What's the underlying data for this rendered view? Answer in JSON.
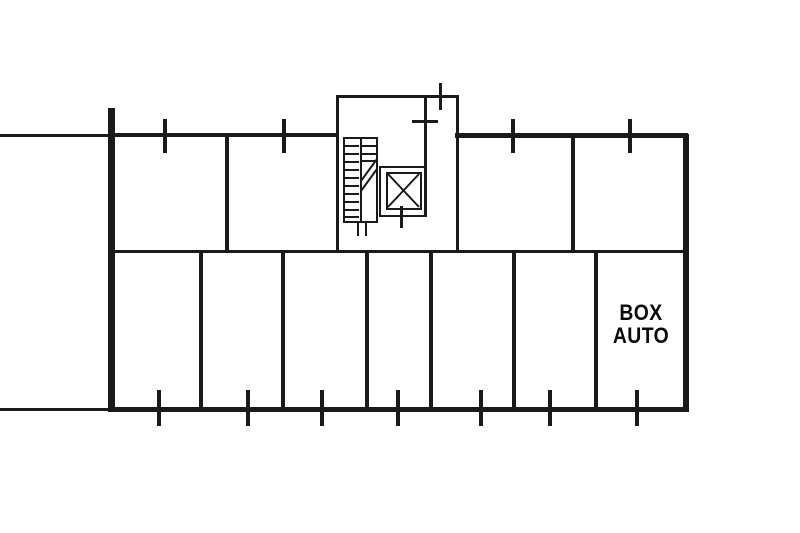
{
  "label": {
    "line1": "BOX",
    "line2": "AUTO"
  },
  "colors": {
    "background": "#ffffff",
    "line": "#1a1a1a",
    "text": "#0a0a0a"
  },
  "plan": {
    "ticks": {
      "top_wall_x": [
        165,
        284,
        513,
        630
      ],
      "bottom_wall_x": [
        159,
        248,
        322,
        398,
        481,
        550,
        637
      ],
      "protrusion_x": [
        440
      ],
      "elevator_x": [
        401
      ]
    },
    "dividers": {
      "upper_x": [
        227,
        573
      ],
      "lower_x": [
        201,
        283,
        367,
        431,
        514,
        596
      ]
    },
    "stairs": {
      "treads_left_y": [
        145,
        153,
        161,
        169,
        177,
        185,
        193,
        201,
        209,
        216
      ],
      "treads_right_y": [
        145,
        153,
        160
      ]
    },
    "rooms": [
      {
        "name": "upper-room-1",
        "x": 112,
        "y": 137,
        "w": 115,
        "h": 113
      },
      {
        "name": "upper-room-2",
        "x": 227,
        "y": 137,
        "w": 110,
        "h": 113
      },
      {
        "name": "stairwell",
        "x": 337,
        "y": 97,
        "w": 122,
        "h": 153
      },
      {
        "name": "upper-room-3",
        "x": 459,
        "y": 137,
        "w": 114,
        "h": 113
      },
      {
        "name": "upper-room-4",
        "x": 573,
        "y": 137,
        "w": 110,
        "h": 113
      },
      {
        "name": "garage-box-1",
        "x": 112,
        "y": 253,
        "w": 89,
        "h": 154
      },
      {
        "name": "garage-box-2",
        "x": 201,
        "y": 253,
        "w": 82,
        "h": 154
      },
      {
        "name": "garage-box-3",
        "x": 283,
        "y": 253,
        "w": 84,
        "h": 154
      },
      {
        "name": "garage-box-4",
        "x": 367,
        "y": 253,
        "w": 64,
        "h": 154
      },
      {
        "name": "garage-box-5",
        "x": 431,
        "y": 253,
        "w": 83,
        "h": 154
      },
      {
        "name": "garage-box-6",
        "x": 514,
        "y": 253,
        "w": 82,
        "h": 154
      },
      {
        "name": "garage-box-labeled",
        "x": 596,
        "y": 253,
        "w": 87,
        "h": 154
      }
    ]
  }
}
